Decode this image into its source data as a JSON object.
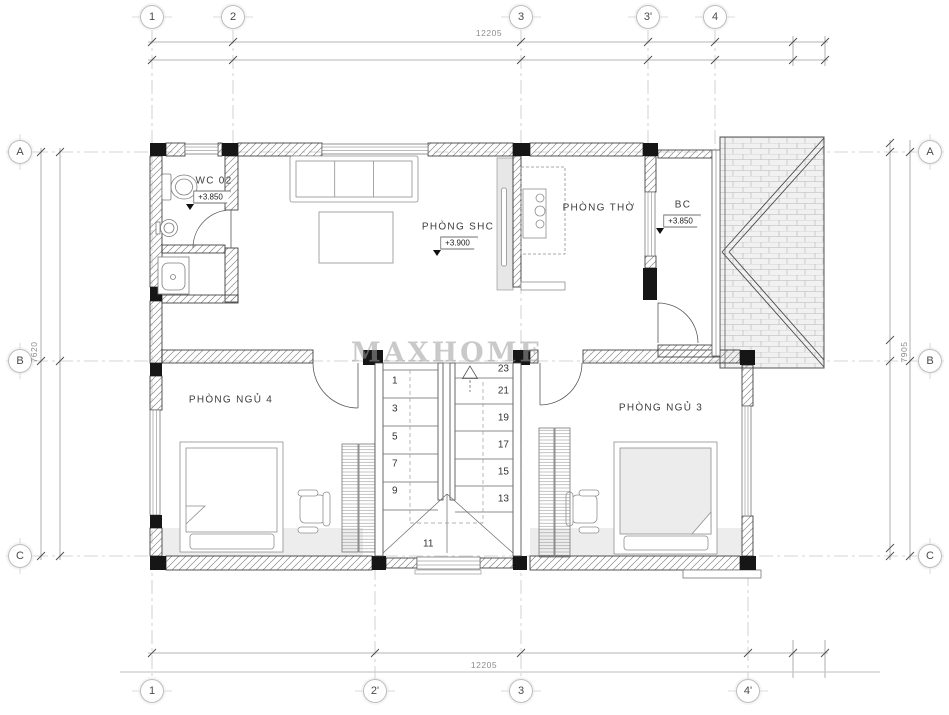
{
  "watermark": "MAXHOME",
  "grid_bubbles": {
    "top": [
      "1",
      "2",
      "3",
      "3'",
      "4"
    ],
    "bottom": [
      "1",
      "2'",
      "3",
      "4'"
    ],
    "left": [
      "A",
      "B",
      "C"
    ],
    "right": [
      "A",
      "B",
      "C"
    ]
  },
  "dimensions": {
    "top_overall": "12205",
    "bottom_overall": "12205",
    "left_overall": "7620",
    "right_overall": "7905"
  },
  "rooms": {
    "wc": {
      "name": "WC 02",
      "level": "+3.850"
    },
    "shc": {
      "name": "PHÒNG SHC",
      "level": "+3.900"
    },
    "tho": {
      "name": "PHÒNG THỜ"
    },
    "bc": {
      "name": "BC",
      "level": "+3.850"
    },
    "ngu4": {
      "name": "PHÒNG NGỦ 4"
    },
    "ngu3": {
      "name": "PHÒNG NGỦ 3"
    }
  },
  "stairs": {
    "left_flight": [
      "1",
      "3",
      "5",
      "7",
      "9"
    ],
    "right_flight": [
      "23",
      "21",
      "19",
      "17",
      "15",
      "13"
    ],
    "landing": "11"
  }
}
